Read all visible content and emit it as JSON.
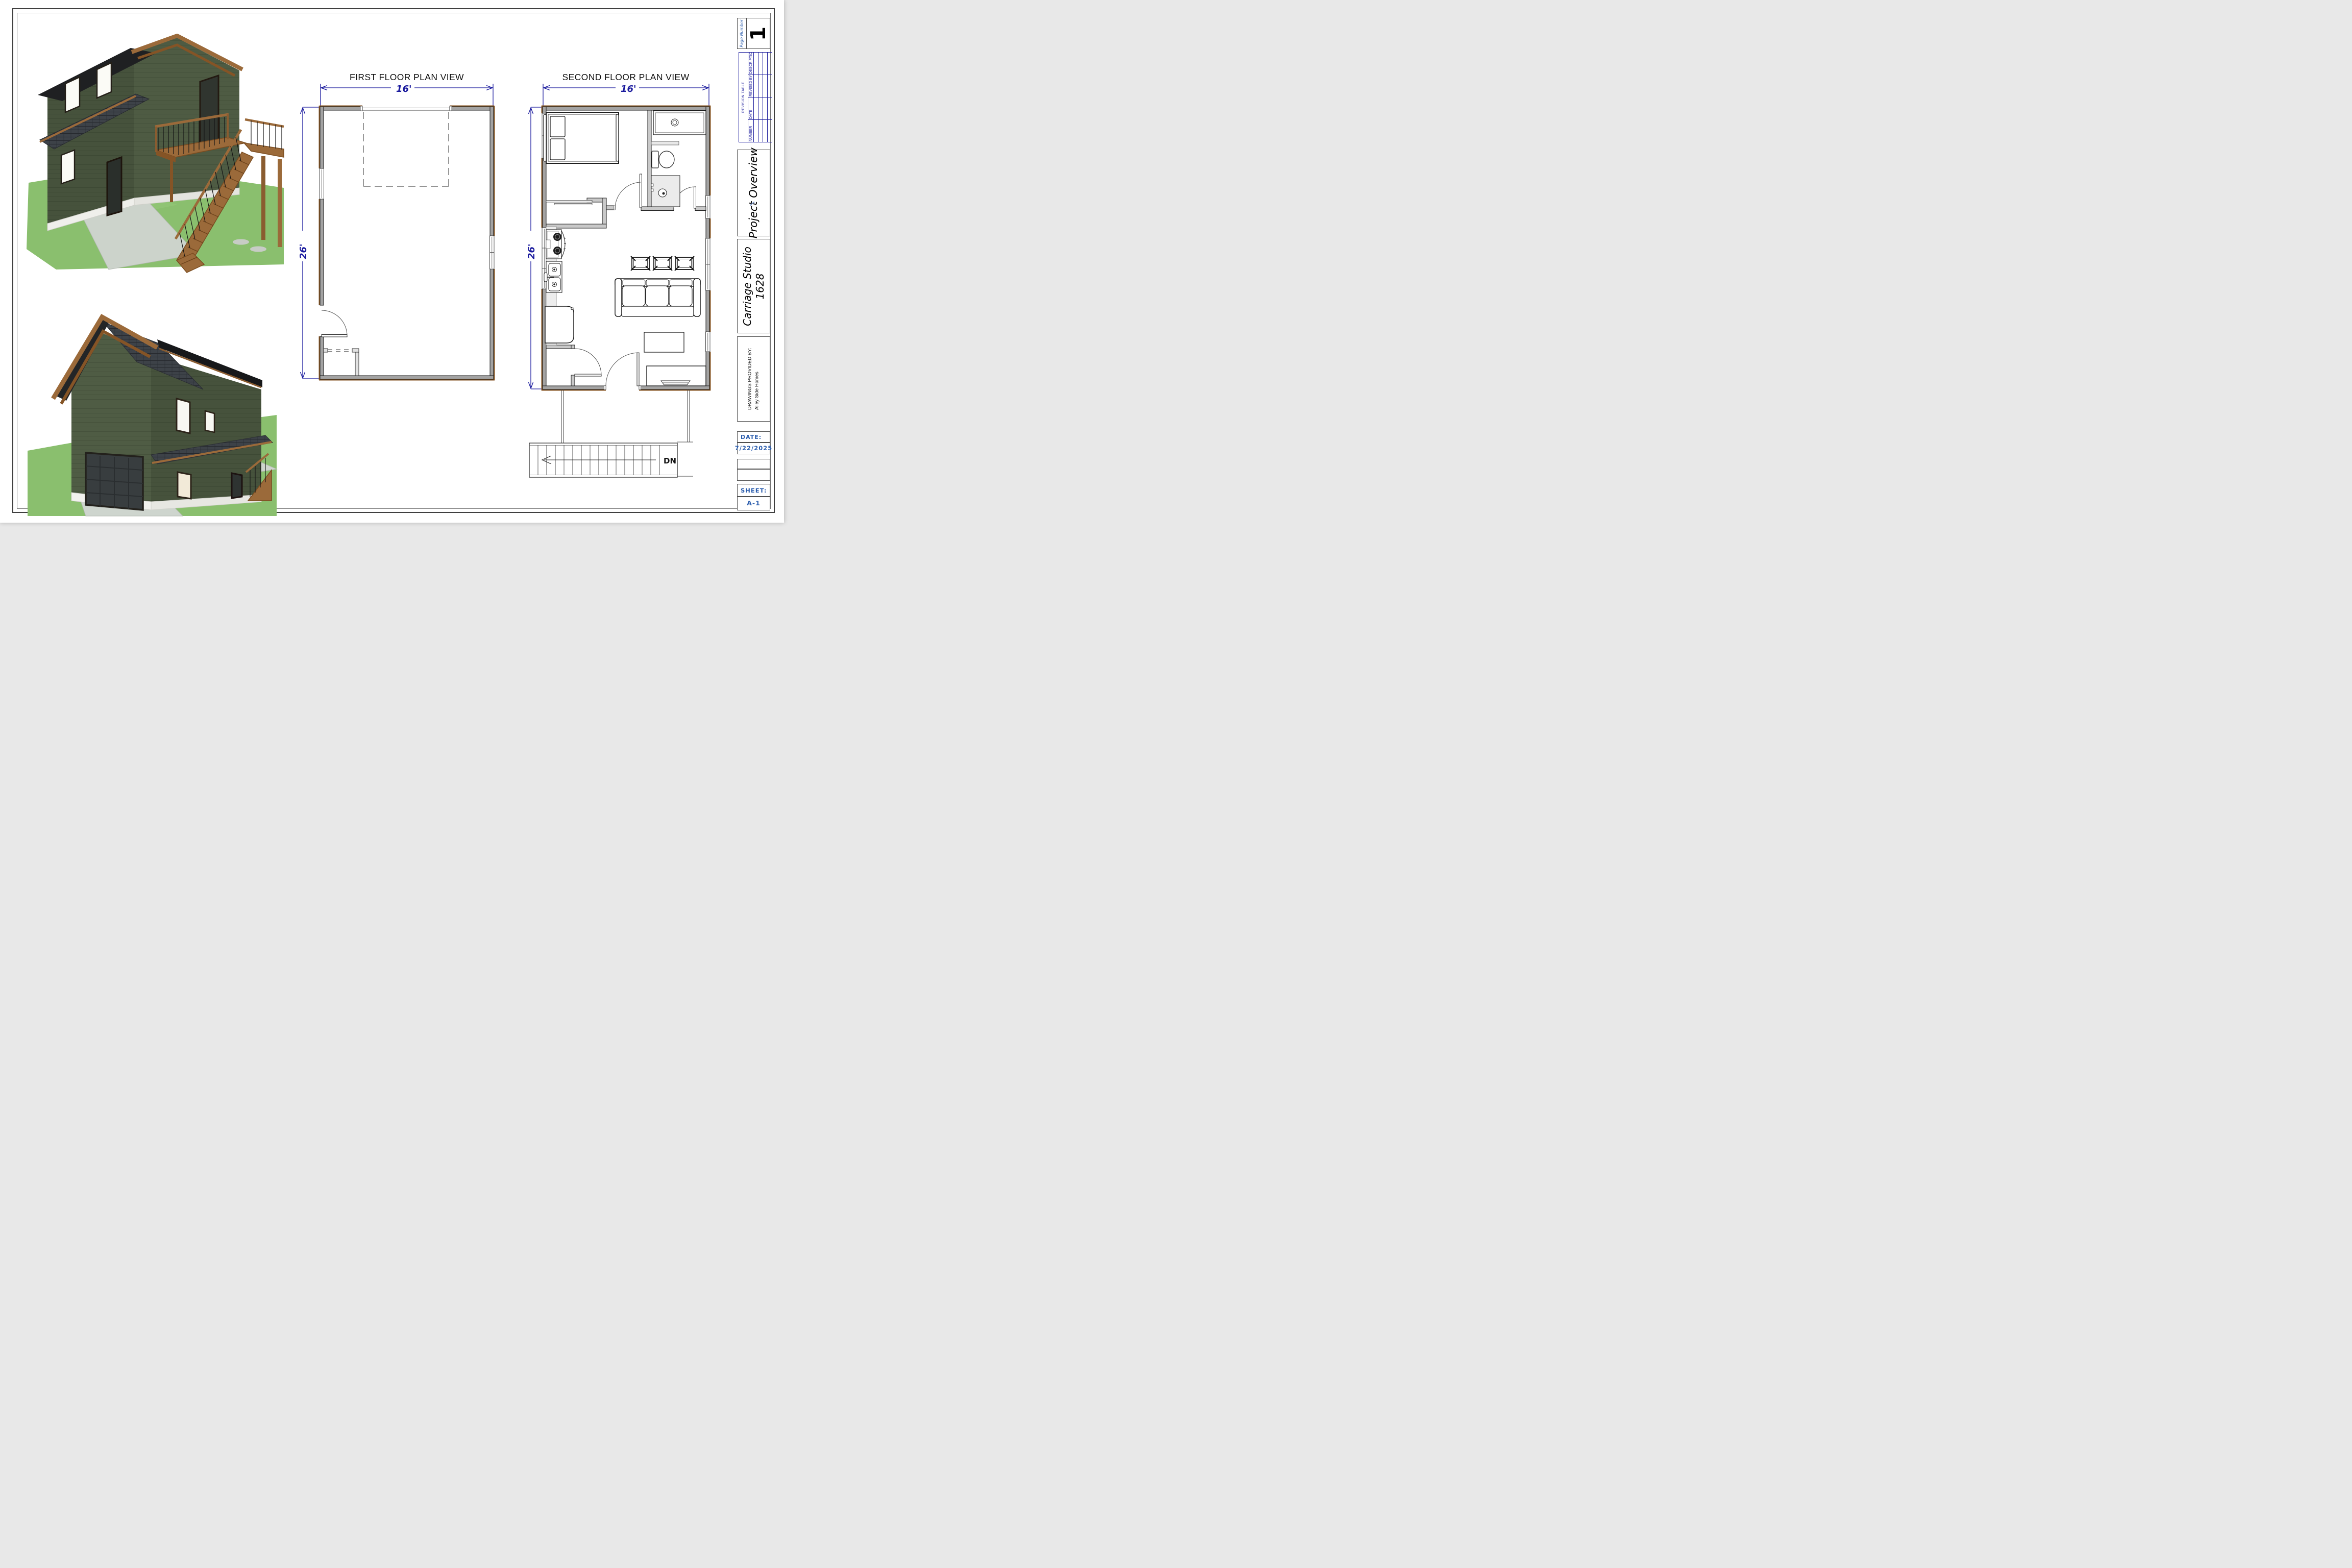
{
  "document": {
    "first_floor": {
      "title": "FIRST FLOOR PLAN VIEW",
      "width_dim": "16'",
      "height_dim": "26'"
    },
    "second_floor": {
      "title": "SECOND FLOOR PLAN VIEW",
      "width_dim": "16'",
      "height_dim": "26'",
      "stair_label": "DN"
    },
    "title_block": {
      "page_number_label": "Page Number",
      "page_number": "1",
      "revision_table": {
        "title": "REVISION TABLE",
        "columns": [
          "NUMBER",
          "DATE",
          "REVISED BY",
          "DESCRIPTION"
        ]
      },
      "project_title": "Project Overview",
      "plan_name": "Carriage Studio",
      "plan_number": "1628",
      "provided_by_label": "DRAWINGS PROVIDED BY:",
      "provided_by": "Alley Side Homes",
      "date_label": "DATE:",
      "date_value": "7/22/2025",
      "sheet_label": "SHEET:",
      "sheet_value": "A-1"
    },
    "colors": {
      "dimension_blue": "#1b1b9e",
      "revision_table_blue": "#1c1c9c",
      "label_blue": "#2b5dad",
      "wall_gray": "#a3a3a3",
      "siding_green": "#4d5a42",
      "siding_green_dark": "#46523c",
      "roof_black": "#1f2022",
      "roof_shingle_gray": "#3f444b",
      "trim_brown": "#9b6a3a",
      "grass_green": "#8abf6e",
      "concrete_gray": "#ced5ce"
    }
  }
}
